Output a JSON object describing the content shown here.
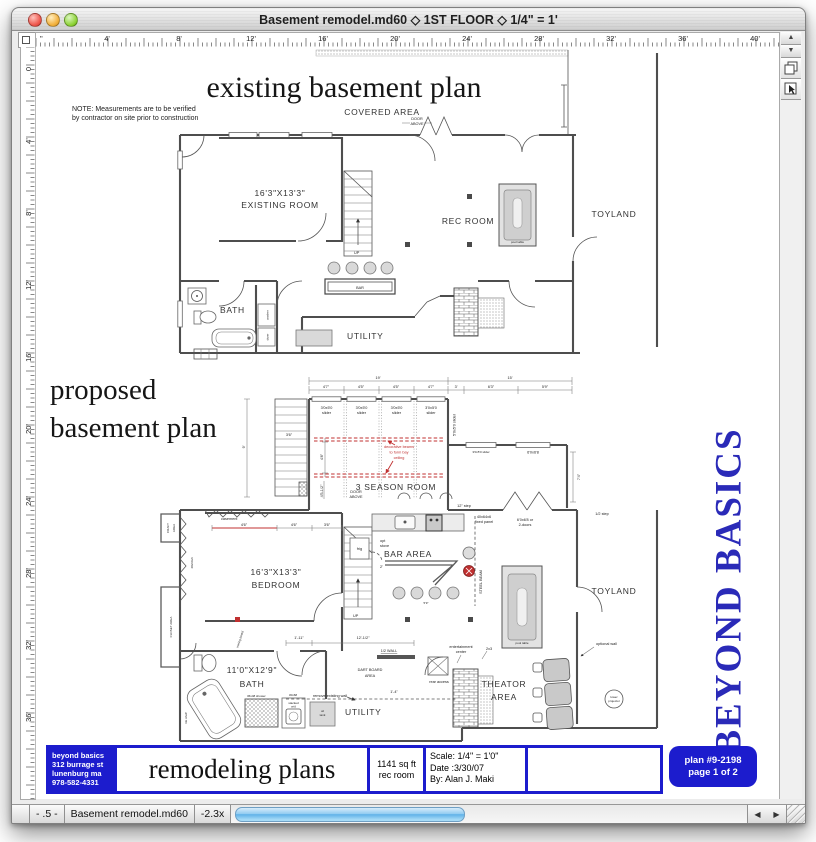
{
  "window": {
    "title": "Basement remodel.md60  ◇  1ST FLOOR  ◇  1/4\" = 1'"
  },
  "rulers": {
    "unit": "\"",
    "top": [
      "4'",
      "8'",
      "12'",
      "16'",
      "20'",
      "24'",
      "28'",
      "32'",
      "36'",
      "40'"
    ],
    "left": [
      "0",
      "4'",
      "8'",
      "12'",
      "16'",
      "20'",
      "24'",
      "28'",
      "32'",
      "36'"
    ]
  },
  "existing": {
    "title": "existing basement plan",
    "note1": "NOTE:  Measurements are to be verified",
    "note2": "by contractor on site prior to construction",
    "covered": "COVERED AREA",
    "door": "DOOR",
    "above": "ABOVE",
    "room_dim": "16'3\"X13'3\"",
    "room": "EXISTING ROOM",
    "rec": "REC ROOM",
    "pool": "pool table",
    "toyland": "TOYLAND",
    "bath": "BATH",
    "bar": "BAR",
    "utility": "UTILITY",
    "washer": "washer",
    "dryer": "dryer",
    "up": "UP"
  },
  "proposed": {
    "title1": "proposed",
    "title2": "basement plan",
    "season": "3 SEASON ROOM",
    "slider_size": "3'0x5'0",
    "slider_word": "slider",
    "slider_right": "5'0x5'0 slider",
    "slider_jut": "3'0x5'0 slider",
    "window_jut": "6'0x6'8",
    "beam1": "decorative beams",
    "beam2": "to form bay",
    "beam3": "ceiling",
    "door": "DOOR",
    "above": "ABOVE",
    "bed_dim": "16'3\"X13'3\"",
    "bed": "BEDROOM",
    "bar_area": "BAR AREA",
    "frig": "frig",
    "opt": "opt",
    "stove": "stove",
    "craft1": "CRAFT",
    "craft2": "AREA",
    "closet": "CLOSET AREA",
    "casement": "casement",
    "win_size": "40x64x6",
    "steel": "STEEL BEAM",
    "toyland": "TOYLAND",
    "pool": "pool table",
    "bath_dim": "11'0\"X12'9\"",
    "bath": "BATH",
    "shower": "36x48 shower",
    "wd_size": "30x68",
    "wd1": "stacked",
    "wd2": "w/d",
    "tile": "tile shelf",
    "ironing": "ironing board",
    "utility": "UTILITY",
    "oil1": "oil",
    "oil2": "tank",
    "dart1": "DART BOARD",
    "dart2": "AREA",
    "half_wall": "1/2 WALL",
    "remove": "remove existing wall",
    "rear": "rear access",
    "ent1": "entertainment",
    "ent2": "center",
    "two_three": "2x3",
    "theater1": "THEATOR",
    "theater2": "AREA",
    "optional": "optional wall",
    "proj1": "lower",
    "proj2": "projector",
    "up": "UP",
    "step12": "12\" step",
    "step_half": "1/2 step",
    "doors1": "6'0x6'8 or",
    "doors2": "2-doors",
    "fixed1": "40x64x6",
    "fixed2": "fixed panel"
  },
  "dims": {
    "d47": "4'7\"",
    "d45": "4'5\"",
    "d19": "19'",
    "d15": "15'",
    "d3": "3'",
    "d63": "6'3\"",
    "d59": "5'9\"",
    "d74": "7'4\"",
    "d48": "4'8\"",
    "d45h": "4'5-1/2\"",
    "d46": "4'6\"",
    "d36": "3'6\"",
    "d2": "2'",
    "d9": "9'",
    "d111": "1'-11\"",
    "d125": "12'-1/2\"",
    "d14": "1'-4\"",
    "d59b": "5'9\""
  },
  "banner": "BEYOND BASICS",
  "title_block": {
    "c1": "beyond basics",
    "c2": "312 burrage st",
    "c3": "lunenburg ma",
    "c4": "978-582-4331",
    "main": "remodeling plans",
    "sq1": "1141 sq ft",
    "sq2": "rec room",
    "scale": "Scale: 1/4\" = 1'0\"",
    "date": "Date :3/30/07",
    "by": "By: Alan J. Maki",
    "plan": "plan #9-2198",
    "page": "page 1 of 2"
  },
  "status": {
    "scale": "- .5 -",
    "file": "Basement remodel.md60",
    "zoom": "-2.3x"
  }
}
